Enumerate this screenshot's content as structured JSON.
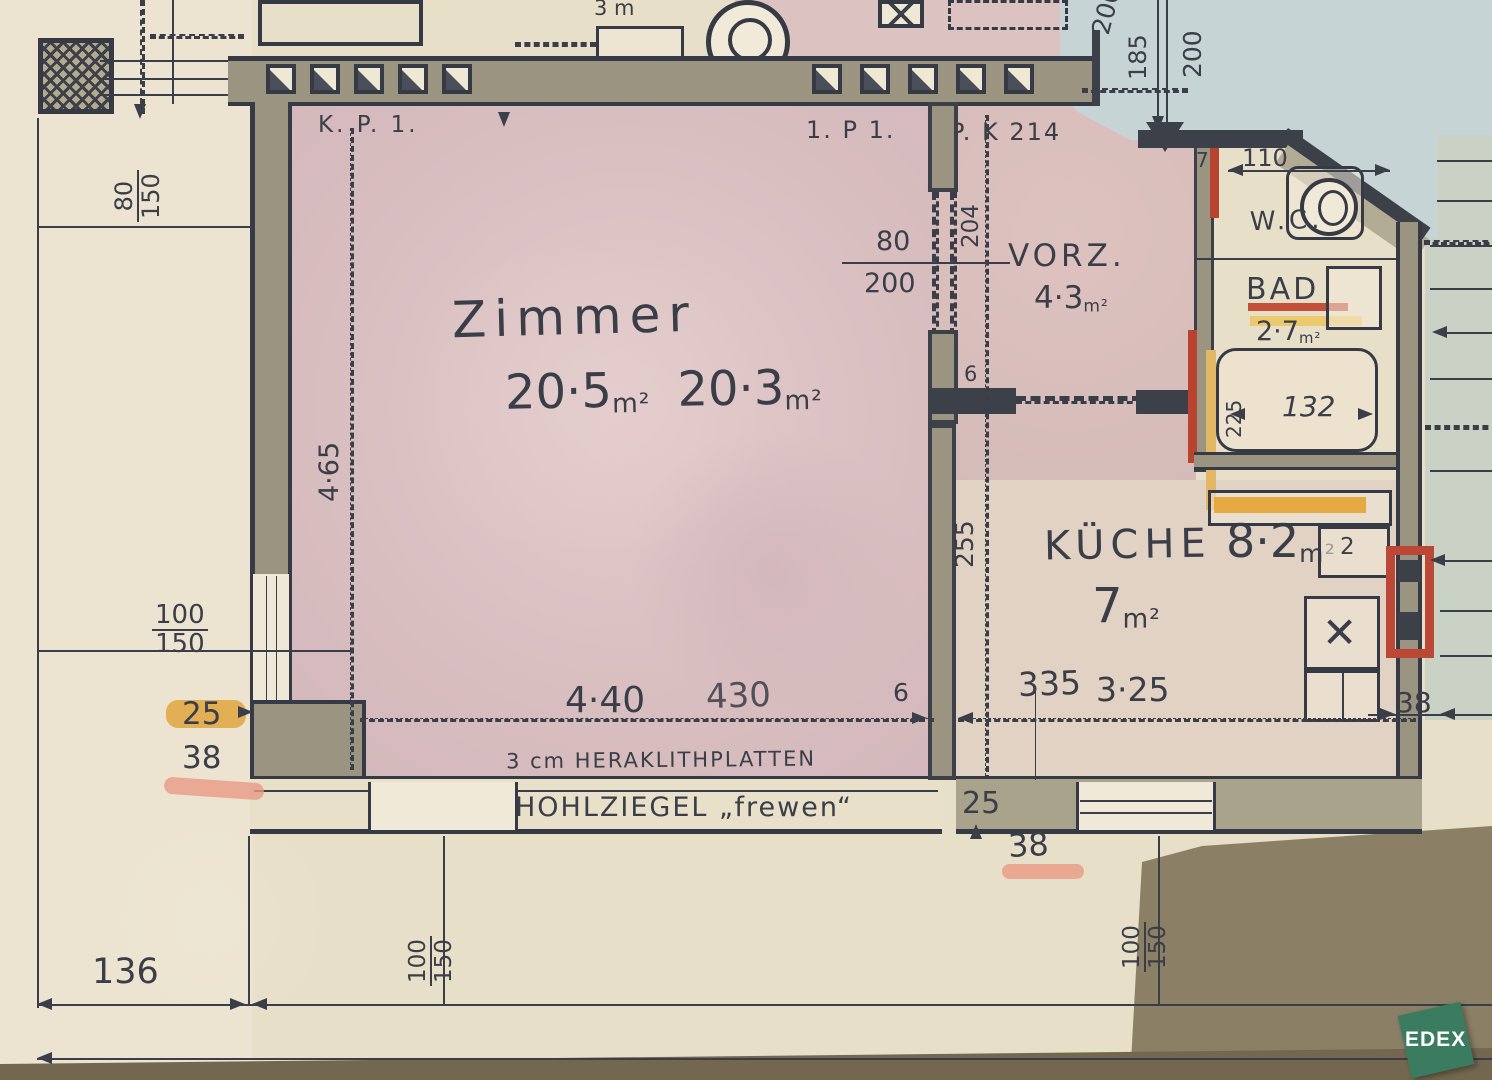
{
  "logo": {
    "text": "EDEX"
  },
  "rooms": {
    "zimmer": {
      "name": "Zimmer",
      "area1_value": "20·5",
      "area1_unit": "m²",
      "area2_value": "20·3",
      "area2_unit": "m²"
    },
    "vorzimmer": {
      "name": "VORZ.",
      "area_value": "4·3",
      "area_unit": "m²"
    },
    "wc": {
      "name": "W.C."
    },
    "bad": {
      "name": "BAD",
      "area_value": "2·7",
      "area_unit": "m²"
    },
    "kueche": {
      "name": "KÜCHE",
      "area1_value": "8·2",
      "area1_unit": "m²",
      "area2_value": "7",
      "area2_unit": "m²"
    }
  },
  "wall_labels": {
    "k": "K",
    "kp1": "K. P. 1.",
    "p1": "1. P 1.",
    "pk214": "P. K 214",
    "top_partial": "3 m"
  },
  "notes": {
    "heraklith": "3 cm HERAKLITHPLATTEN",
    "hohlziegel": "HOHLZIEGEL „frewen“"
  },
  "dimensions": {
    "left_win_top": "80",
    "left_win_bottom": "150",
    "left_height": "4·65",
    "left_win2_top": "100",
    "left_win2_bottom": "150",
    "left_25": "25",
    "left_38": "38",
    "bottom_136": "136",
    "bottom_win_left_top": "100",
    "bottom_win_left_bottom": "150",
    "zimmer_width_a": "4·40",
    "zimmer_width_b": "430",
    "wall_6_top": "6",
    "wall_6_bottom": "6",
    "kueche_width_a": "335",
    "kueche_width_b": "3·25",
    "mid_25": "25",
    "mid_38": "38",
    "bottom_win_right_top": "100",
    "bottom_win_right_bottom": "150",
    "door_80": "80",
    "door_200": "200",
    "vorz_204": "204",
    "vorz_255": "255",
    "top_200a": "200",
    "top_185": "185",
    "top_200b": "200",
    "wc_7": "7",
    "wc_110": "110",
    "bad_225": "225",
    "bad_132": "132",
    "right_38": "38",
    "sink_2": "2"
  },
  "symbols": {
    "stove_x": "✕"
  }
}
